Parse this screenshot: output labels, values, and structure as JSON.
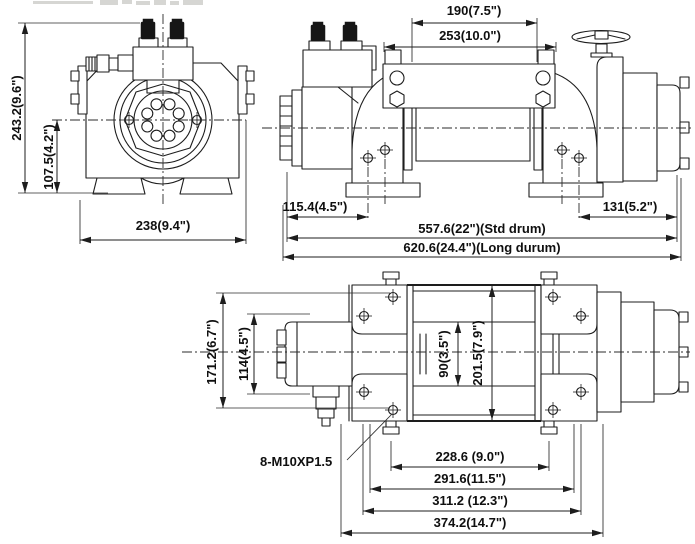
{
  "views": {
    "end_view": {
      "dims": {
        "overall_height": "243.2(9.6\")",
        "center_height": "107.5(4.2\")",
        "overall_width": "238(9.4\")"
      }
    },
    "front_view": {
      "dims": {
        "tie_bar_inner": "190(7.5\")",
        "tie_bar_outer": "253(10.0\")",
        "motor_end_offset": "115.4(4.5\")",
        "gear_end_offset": "131(5.2\")",
        "overall_length_std": "557.6(22\")(Std drum)",
        "overall_length_long": "620.6(24.4\")(Long durum)"
      }
    },
    "top_view": {
      "dims": {
        "overall_depth": "171.2(6.7\")",
        "motor_depth": "114(4.5\")",
        "drum_inner_width": "90(3.5\")",
        "flange_width": "201.5(7.9\")",
        "bolt_spec": "8-M10XP1.5",
        "bolt_spacing": "228.6 (9.0\")",
        "frame_width": "291.6(11.5\")",
        "mount_width": "311.2 (12.3\")",
        "overall_width": "374.2(14.7\")"
      }
    }
  }
}
